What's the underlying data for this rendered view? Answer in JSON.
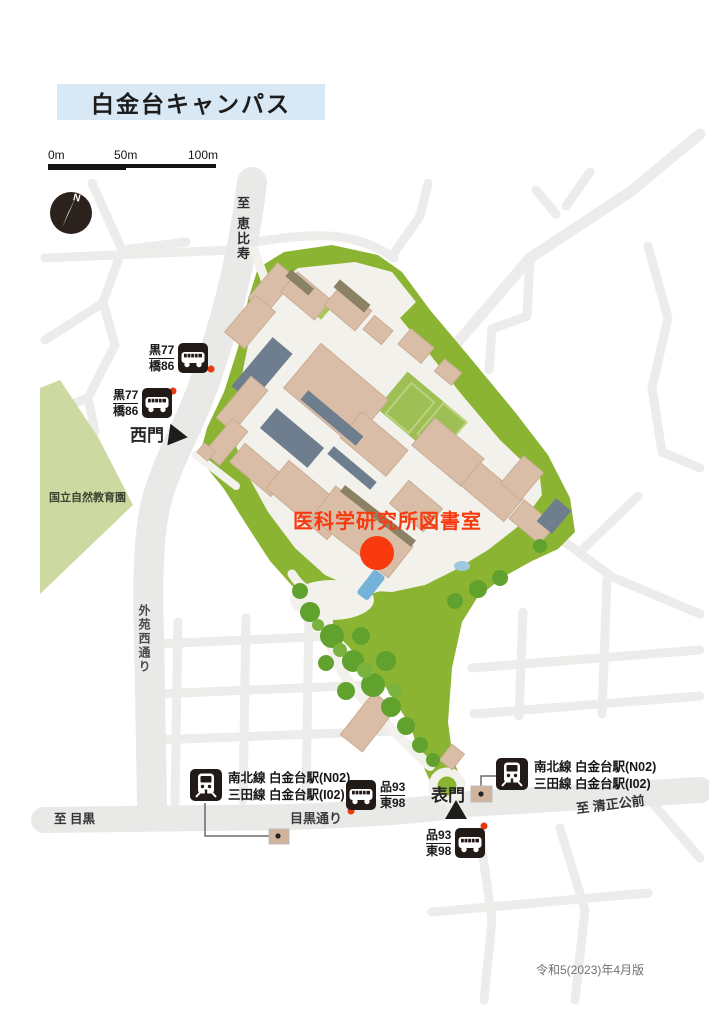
{
  "page": {
    "title": "白金台キャンパス",
    "version_note": "令和5(2023)年4月版"
  },
  "scale_bar": {
    "labels": [
      "0m",
      "50m",
      "100m"
    ]
  },
  "compass": {
    "label": "N"
  },
  "roads": {
    "to_ebisu": "至 恵比寿",
    "gaien_nishi_dori": "外苑西通り",
    "meguro_dori": "目黒通り",
    "to_meguro": "至 目黒",
    "to_kiyomasa_koumae": "至 清正公前"
  },
  "areas": {
    "nature_park": "国立自然教育園"
  },
  "gates": {
    "west": "西門",
    "main": "表門"
  },
  "destination": {
    "label": "医科学研究所図書室"
  },
  "bus_stops": [
    {
      "routes": [
        "黒77",
        "橋86"
      ]
    },
    {
      "routes": [
        "黒77",
        "橋86"
      ]
    },
    {
      "routes": [
        "品93",
        "東98"
      ]
    },
    {
      "routes": [
        "品93",
        "東98"
      ]
    }
  ],
  "stations": [
    {
      "lines": [
        "南北線 白金台駅(N02)",
        "三田線 白金台駅(I02)"
      ]
    },
    {
      "lines": [
        "南北線 白金台駅(N02)",
        "三田線 白金台駅(I02)"
      ]
    }
  ],
  "colors": {
    "title_bg": "#d9e8f5",
    "destination_red": "#f93a0f",
    "campus_green": "#8cb433",
    "park_green": "#ccdaa2",
    "building_tan": "#d9bda7",
    "building_slate": "#6e7e8f",
    "road_gray": "#e9e9e8",
    "campus_ground": "#f3f1ec",
    "icon_bg": "#221a16",
    "stop_dot_red": "#e8380d"
  }
}
